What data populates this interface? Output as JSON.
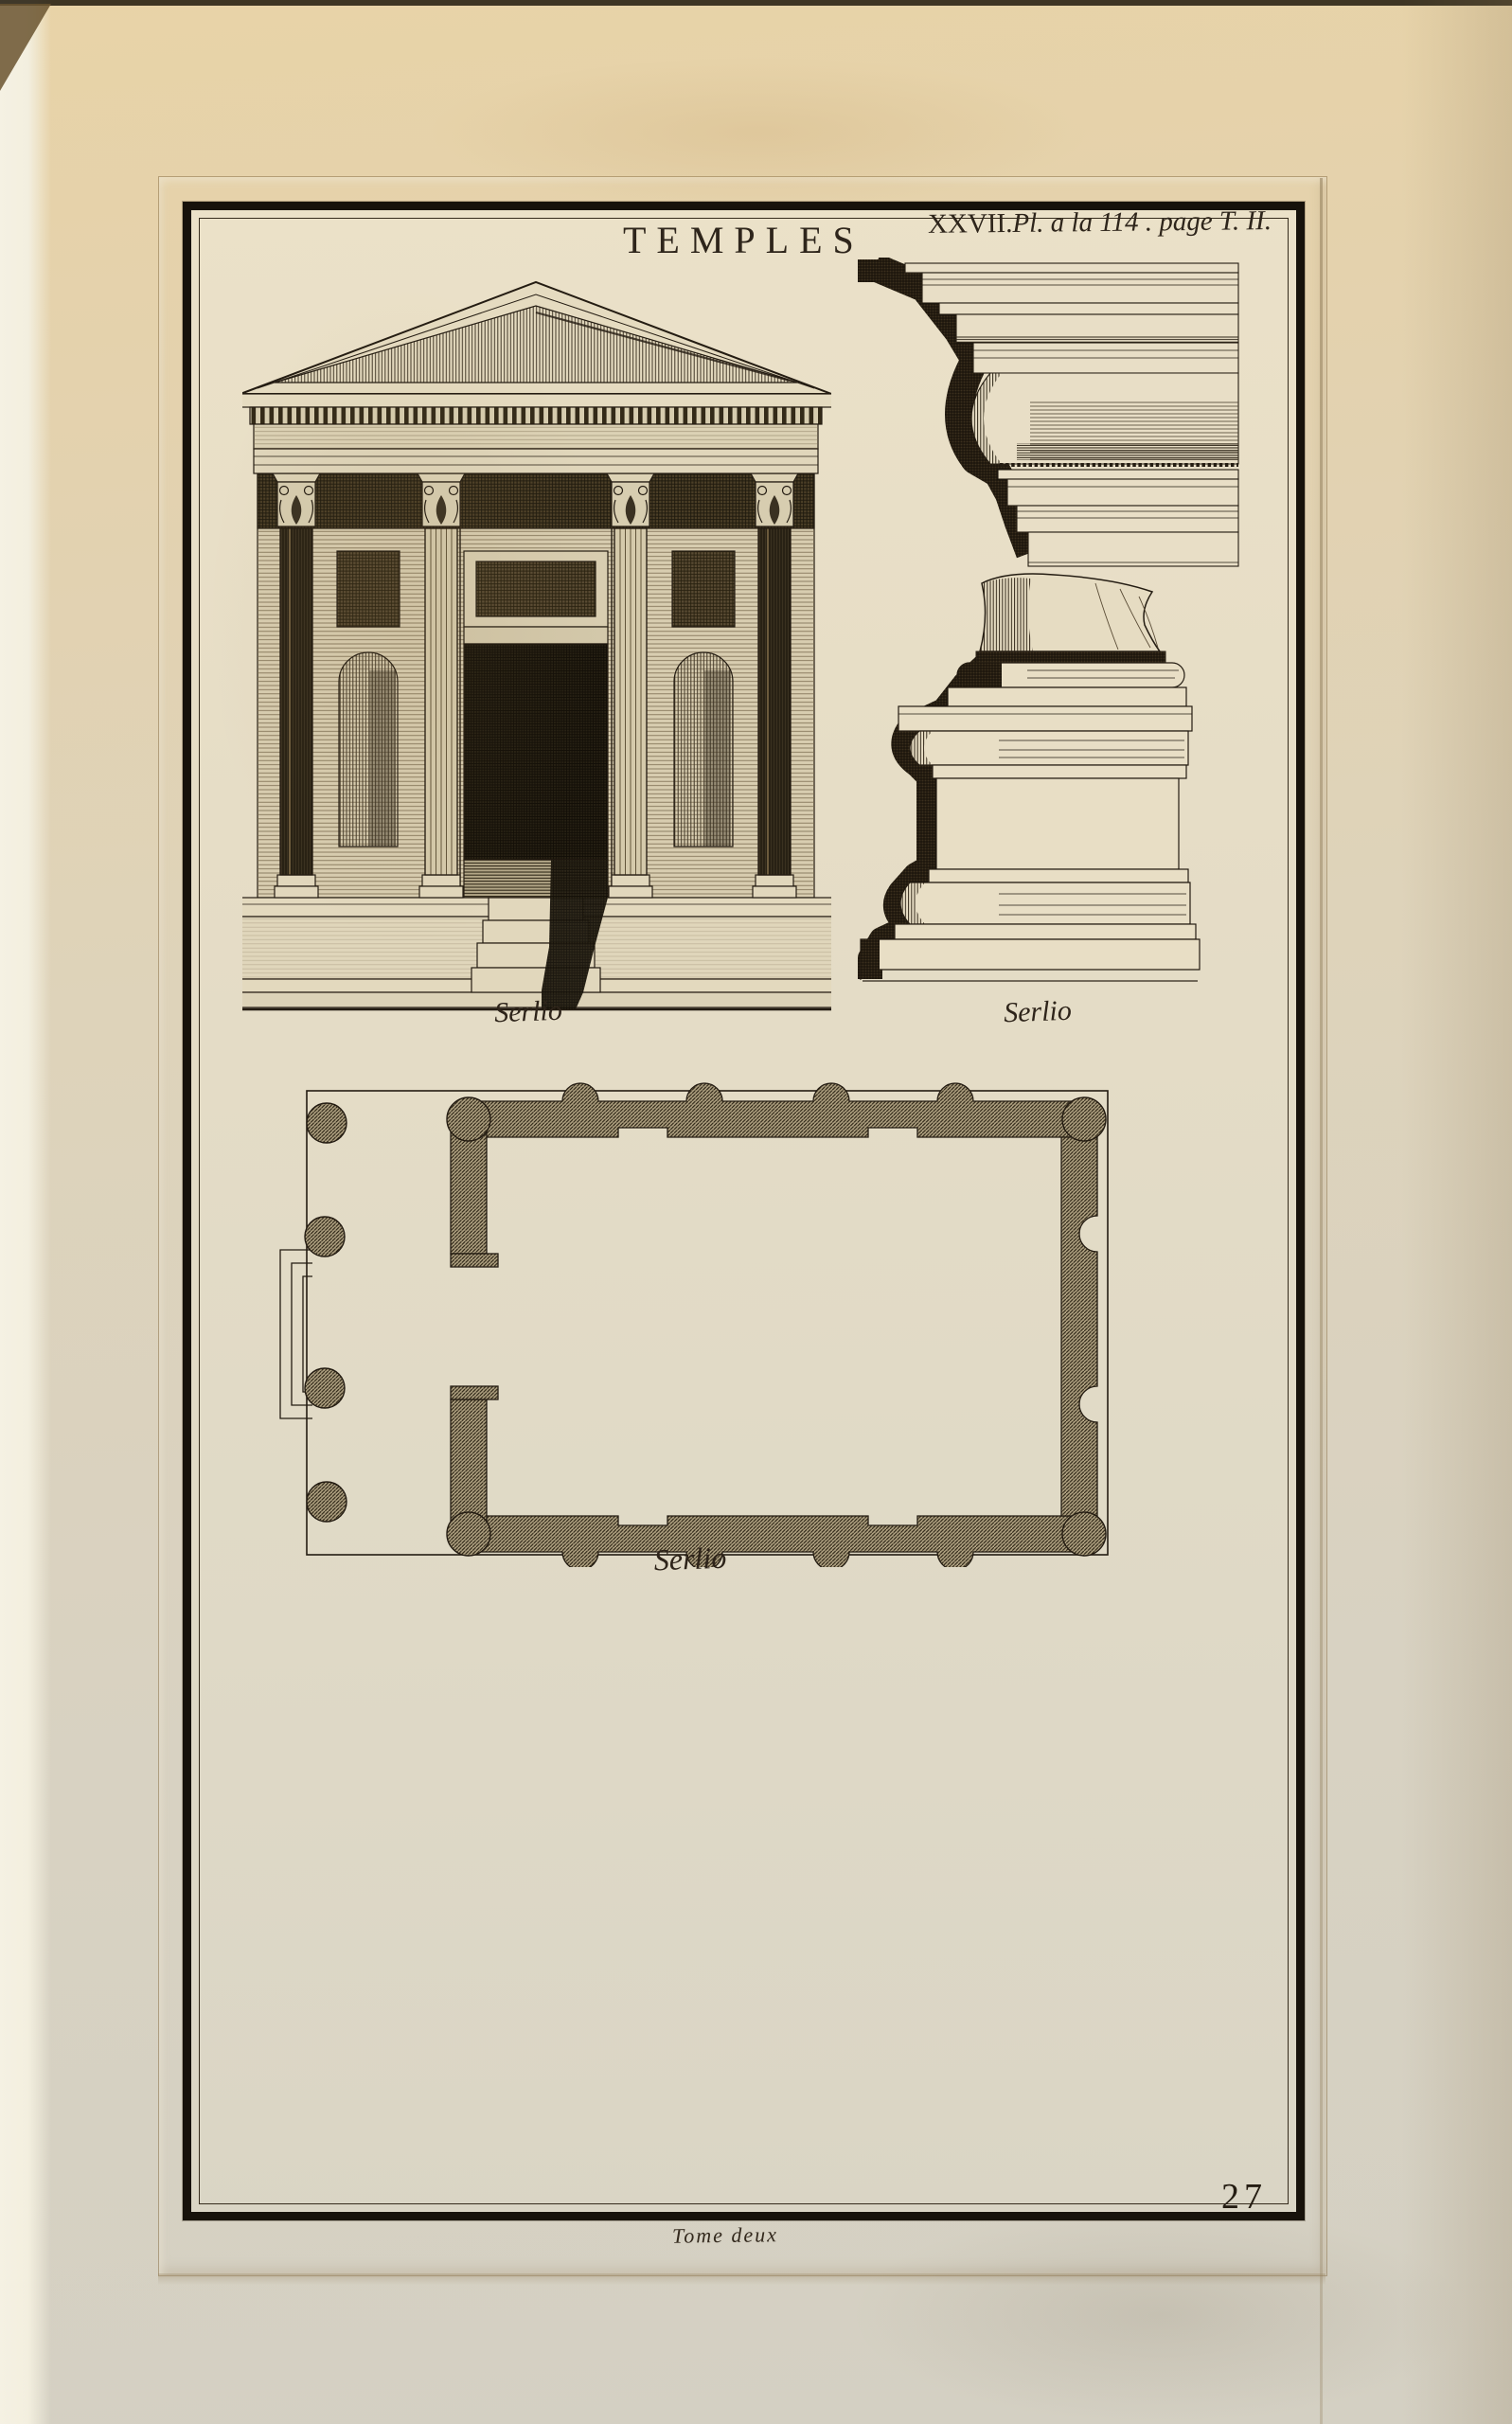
{
  "page": {
    "title": "TEMPLES",
    "plate_ref": {
      "roman": "XXVII.",
      "italic": "Pl. a la 114 . page T. II."
    },
    "page_number": "27",
    "footer_note": "Tome deux"
  },
  "figures": [
    {
      "id": "facade-elevation",
      "caption": "Serlio"
    },
    {
      "id": "entablature-cornice-profile",
      "caption": ""
    },
    {
      "id": "column-base-pedestal-profile",
      "caption": "Serlio"
    },
    {
      "id": "temple-floor-plan",
      "caption": "Serlio"
    }
  ],
  "colors": {
    "paper": "#e3d0ab",
    "plate_paper": "#e8dfc8",
    "ink": "#241c12",
    "frame": "#17120b"
  }
}
